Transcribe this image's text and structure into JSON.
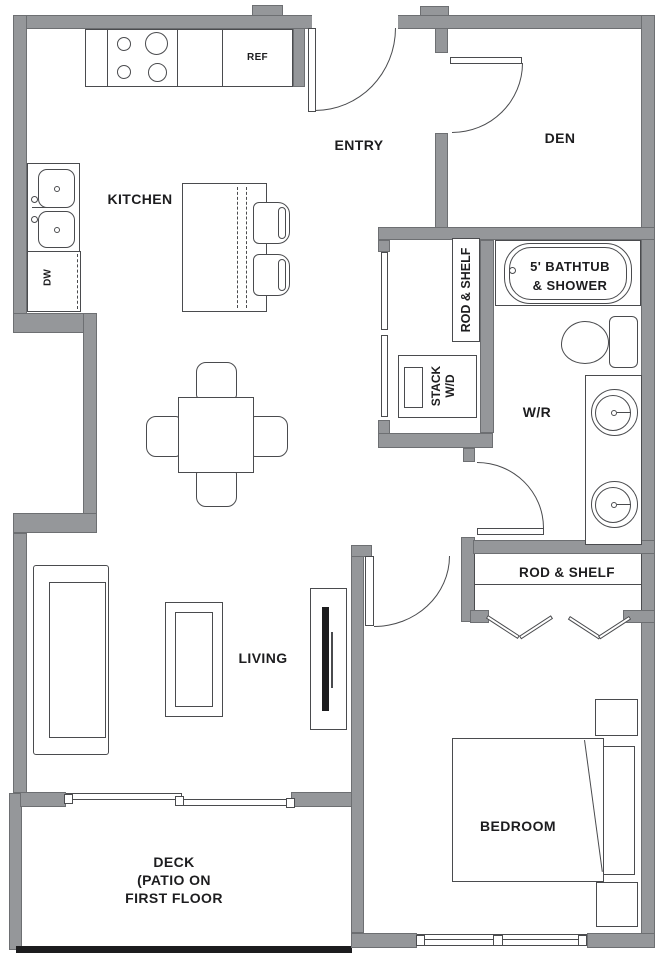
{
  "title": "One-bedroom floor plan",
  "rooms": {
    "kitchen": "KITCHEN",
    "entry": "ENTRY",
    "den": "DEN",
    "wr": "W/R",
    "living": "LIVING",
    "bedroom": "BEDROOM",
    "deck_line1": "DECK",
    "deck_line2": "(PATIO ON",
    "deck_line3": "FIRST FLOOR"
  },
  "fixtures": {
    "ref": "REF",
    "dw": "DW",
    "stack_wd_line1": "STACK",
    "stack_wd_line2": "W/D",
    "rod_shelf_entry_closet": "ROD & SHELF",
    "rod_shelf_bedroom_closet": "ROD & SHELF",
    "bathtub_line1": "5' BATHTUB",
    "bathtub_line2": "& SHOWER"
  },
  "colors": {
    "wall": "#95979a",
    "wall_edge": "#6d6f72",
    "line": "#4a4b4e",
    "text": "#1d1d1f",
    "deck_edge": "#1c1c1e",
    "background": "#ffffff"
  }
}
